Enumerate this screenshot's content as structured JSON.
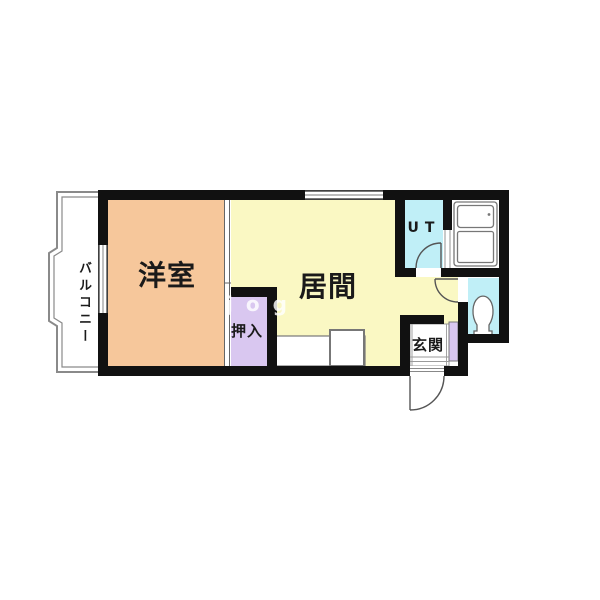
{
  "page": {
    "background_color": "#ffffff"
  },
  "floorplan": {
    "wall_color": "#111111",
    "fixture_line_color": "#6e6e6e",
    "balcony_line_color": "#8a8a8a",
    "watermark_text": "jog",
    "rooms": [
      {
        "id": "yoshitsu",
        "label": "洋室",
        "color": "#f6c79b"
      },
      {
        "id": "ima",
        "label": "居間",
        "color": "#faf8c3"
      },
      {
        "id": "oshiire",
        "label": "押入",
        "color": "#d9c7f0"
      },
      {
        "id": "ut",
        "label": "UT",
        "color": "#c0eff7"
      },
      {
        "id": "bath",
        "label": "",
        "color": "#ffffff"
      },
      {
        "id": "toilet",
        "label": "",
        "color": "#c0eff7"
      },
      {
        "id": "genkan",
        "label": "玄関",
        "color": "#ffffff"
      },
      {
        "id": "balcony",
        "label": "バルコニー",
        "color": "#ffffff"
      },
      {
        "id": "cabinet",
        "label": "",
        "color": "#d9c7f0"
      }
    ],
    "icons": {
      "bathtub": "bathtub-top-view-icon",
      "toilet": "toilet-top-view-icon",
      "kitchen": "kitchen-counter-with-sink-icon",
      "doors": "door-swing-arc-icon",
      "windows": "window-double-line-icon"
    }
  }
}
